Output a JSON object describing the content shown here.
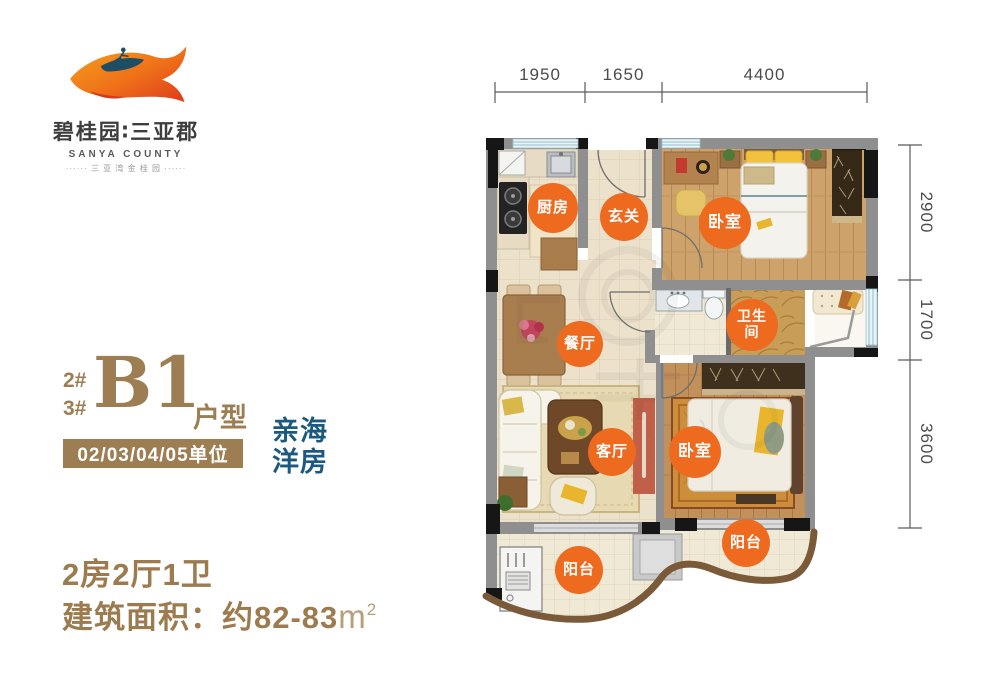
{
  "logo": {
    "icon": "bird-surfer-logo",
    "name_cn": "碧桂园∶三亚郡",
    "name_en": "SANYA COUNTY",
    "subtitle": "······ 三 亚 湾 金 桂 园 ······"
  },
  "unit": {
    "building_no_1": "2#",
    "building_no_2": "3#",
    "type_code": "B1",
    "type_label": "户型",
    "units_banner": "02/03/04/05单位",
    "tagline_line1": "亲海",
    "tagline_line2": "洋房"
  },
  "summary": {
    "layout": "2房2厅1卫",
    "area_label": "建筑面积：约82-83",
    "area_unit_base": "m",
    "area_unit_sup": "2"
  },
  "floorplan": {
    "rooms": [
      {
        "id": "kitchen",
        "label": "厨房"
      },
      {
        "id": "entry",
        "label": "玄关"
      },
      {
        "id": "bedroom-1",
        "label": "卧室"
      },
      {
        "id": "dining",
        "label": "餐厅"
      },
      {
        "id": "bathroom",
        "label": "卫生间"
      },
      {
        "id": "living",
        "label": "客厅"
      },
      {
        "id": "bedroom-2",
        "label": "卧室"
      },
      {
        "id": "balcony-left",
        "label": "阳台"
      },
      {
        "id": "balcony-right",
        "label": "阳台"
      }
    ],
    "dimensions_top": [
      "1950",
      "1650",
      "4400"
    ],
    "dimensions_right": [
      "2900",
      "1700",
      "3600"
    ]
  },
  "colors": {
    "accent_orange": "#ee6a1f",
    "brand_brown": "#9d7d52",
    "tagline_teal": "#1b5a7e",
    "wall_gray": "#8f8f8f",
    "balcony_wall_brown": "#7a5a39"
  }
}
